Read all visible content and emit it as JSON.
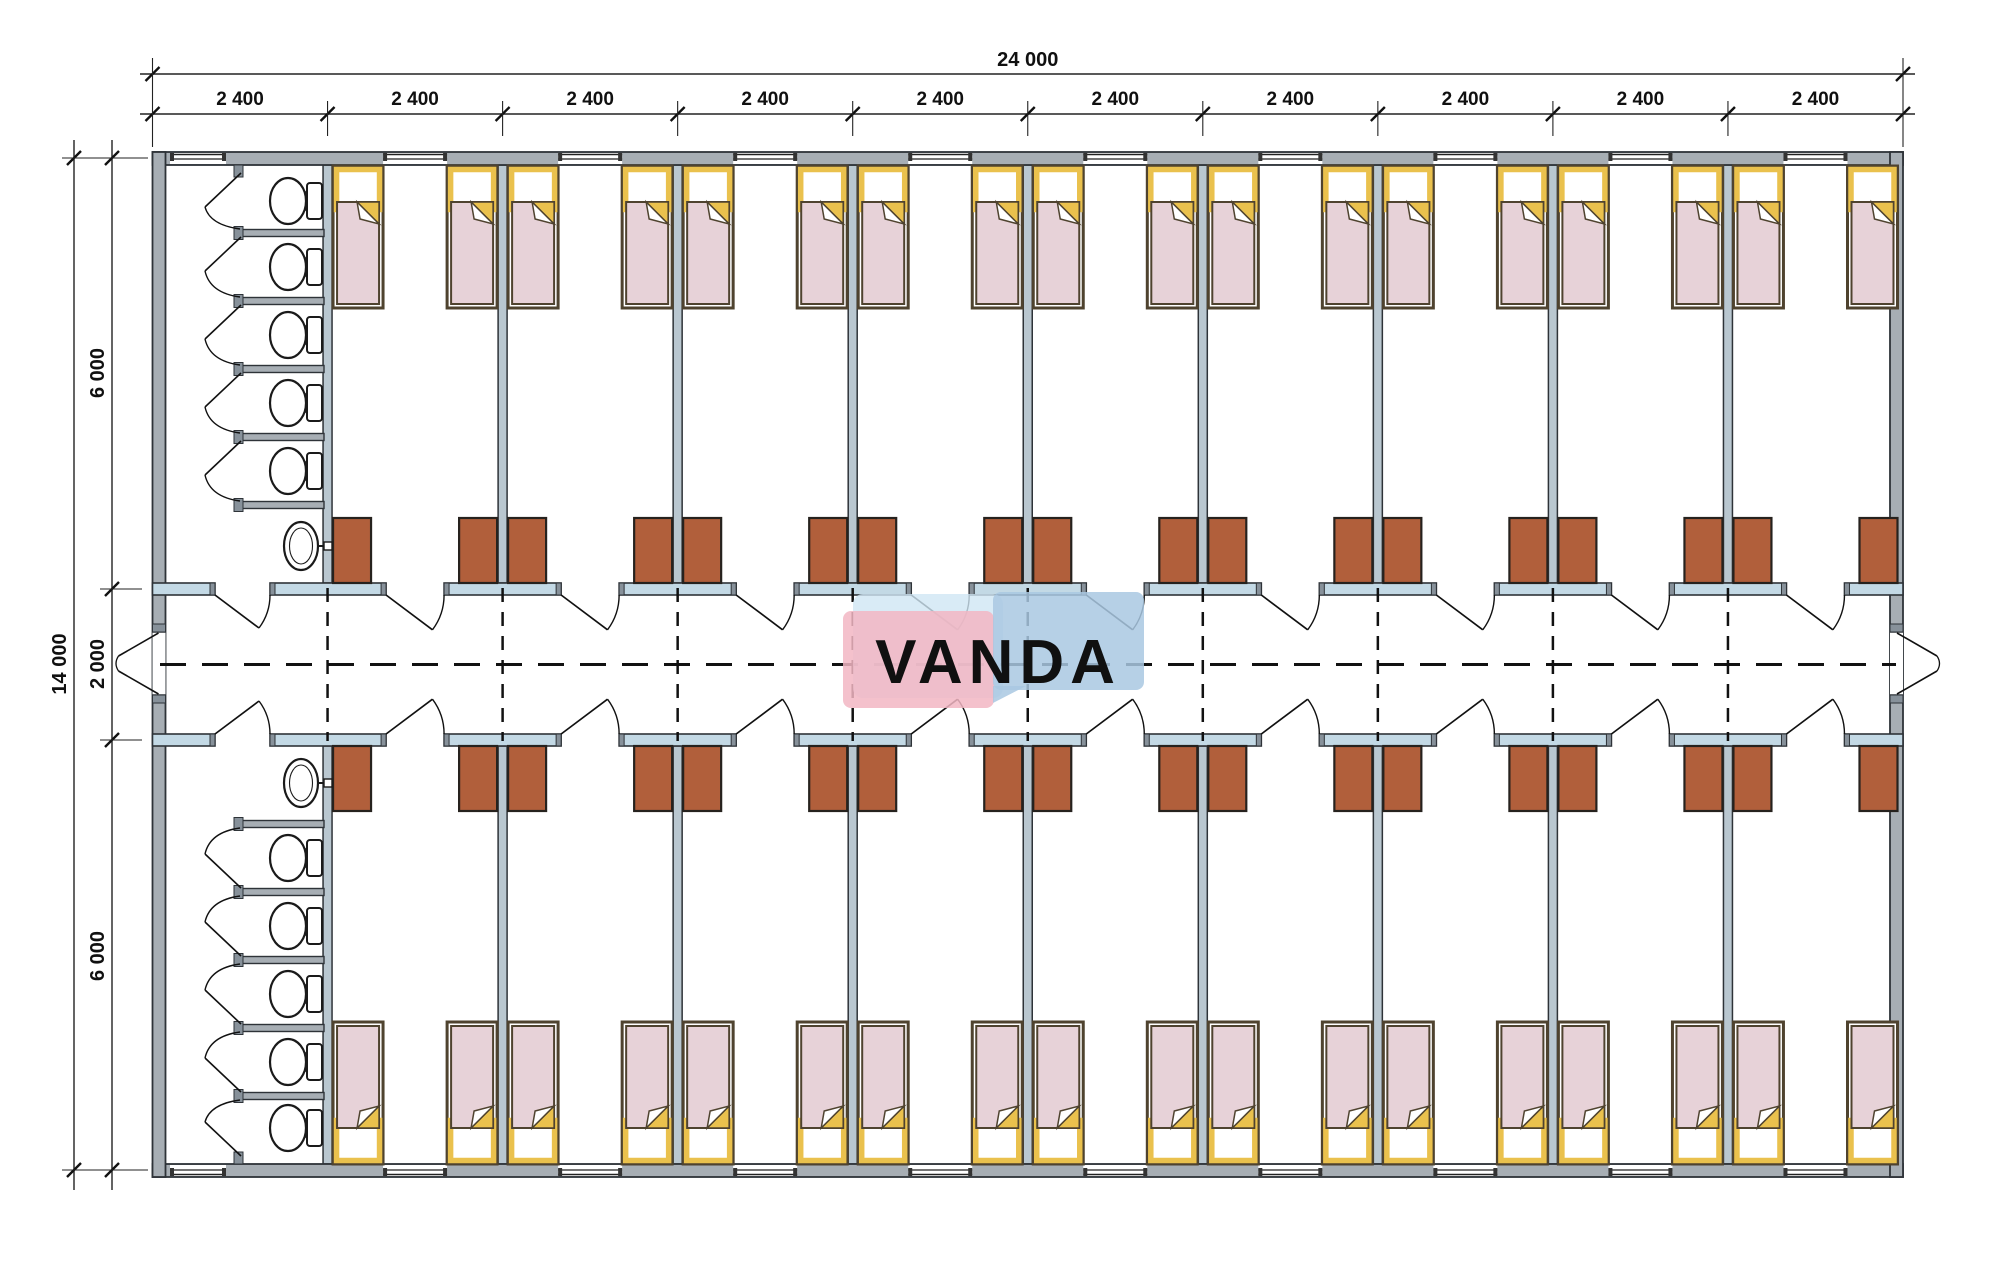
{
  "drawing": {
    "type": "floor_plan",
    "description": "Dormitory container building plan: central corridor, 9 double rooms per wing, toilet block with 5 stalls and washbasin per wing"
  },
  "dimensions": {
    "top_total": "24 000",
    "top_segments": [
      "2 400",
      "2 400",
      "2 400",
      "2 400",
      "2 400",
      "2 400",
      "2 400",
      "2 400",
      "2 400",
      "2 400"
    ],
    "left_total": "14 000",
    "left_segments": [
      "6 000",
      "2 000",
      "6 000"
    ]
  },
  "layout": {
    "bays": 10,
    "rooms_per_wing": 9,
    "beds_per_room": 2,
    "wardrobes_per_room": 2,
    "toilet_stalls_per_block": 5,
    "washbasins_per_block": 1,
    "corridor_doors_per_room": 1,
    "corridor_end_doors": 2
  },
  "watermark": {
    "text": "VANDA"
  },
  "colors": {
    "wall": "#a7aeb4",
    "wall_outline": "#2e3338",
    "partition": "#b9c7d0",
    "threshold": "#c3d9e5",
    "post": "#87919a",
    "wardrobe": "#b15f3b",
    "wardrobe_outline": "#26221e",
    "bed_mattress": "#e7d2d8",
    "bed_frame": "#4f432f",
    "bed_pillow_frame": "#eac14d",
    "fixture_outline": "#1a1a1a",
    "dashed_line": "#111111",
    "dimension_line": "#222222",
    "watermark_pink": "#f2b6c3",
    "watermark_blue": "#a9c8e2",
    "watermark_light_blue": "#cfe6f4",
    "watermark_text_color": "#ffffff"
  }
}
